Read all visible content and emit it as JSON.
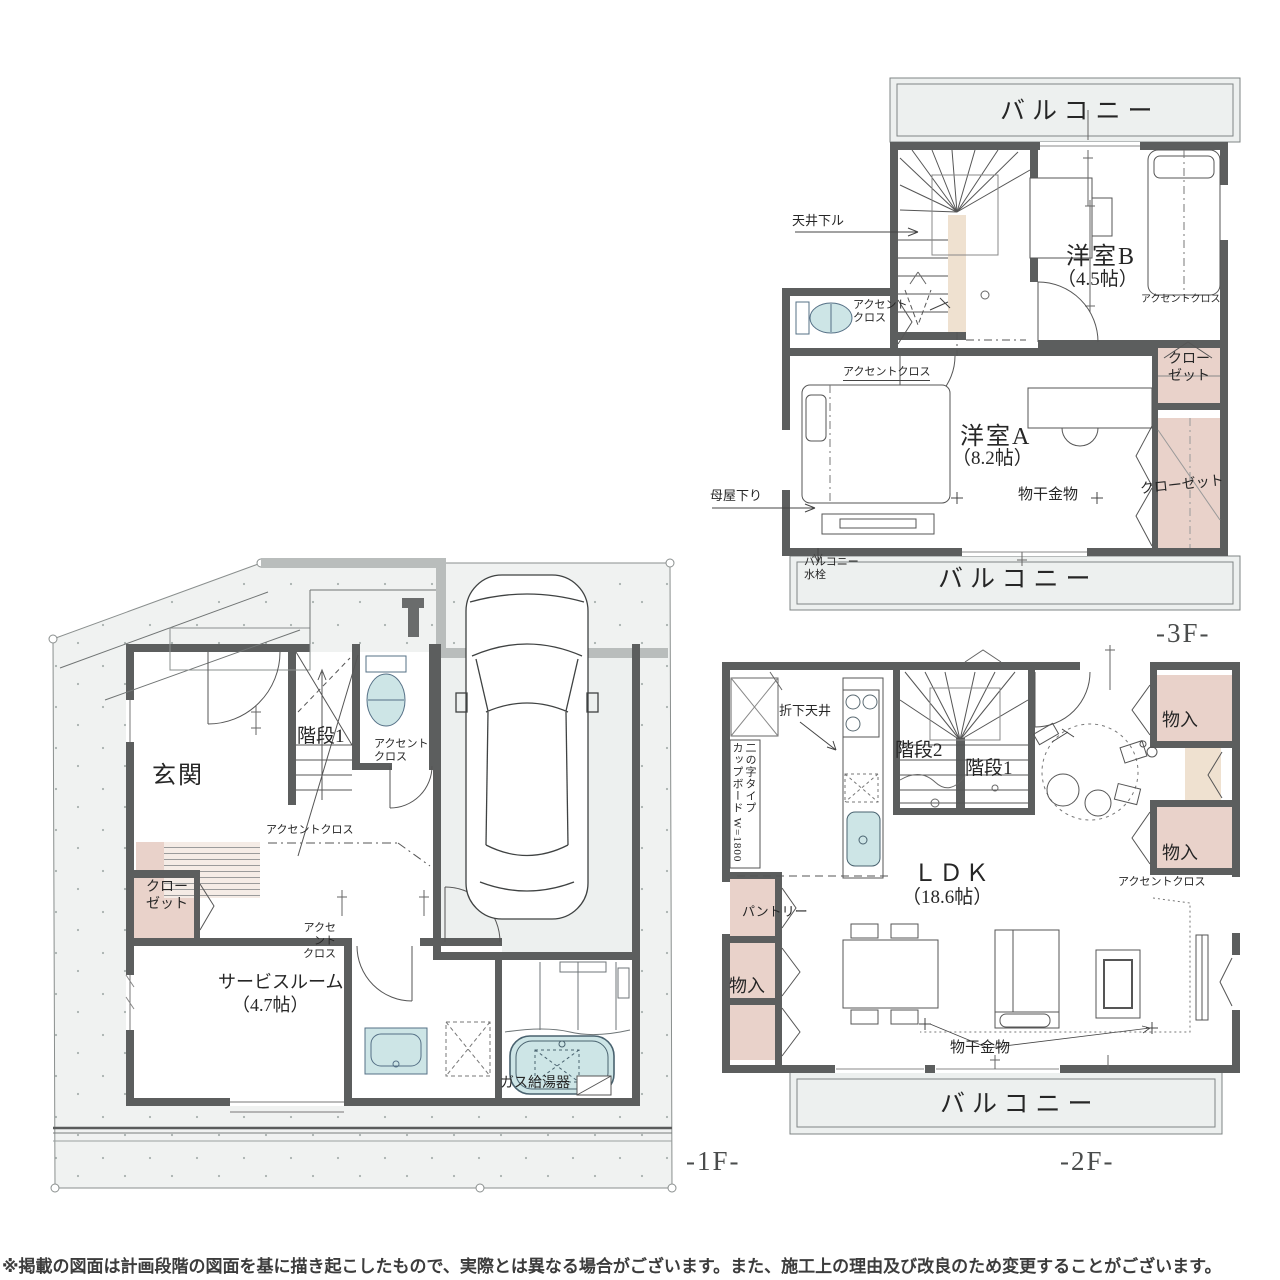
{
  "disclaimer": "※掲載の図面は計画段階の図面を基に描き起こしたもので、実際とは異なる場合がございます。また、施工上の理由及び改良のため変更することがございます。",
  "colors": {
    "wall": "#5c5e5e",
    "closet_pink": "#e9d2ca",
    "fixture_blue": "#cde5e6",
    "balcony_gray": "#edf0ef",
    "accent_beige": "#efe1d0"
  },
  "floor1": {
    "tag": "-1F-",
    "genkan": "玄関",
    "kaidan1": "階段1",
    "accent_cross_toilet": "アクセント\nクロス",
    "accent_cross_hall": "アクセントクロス",
    "closet": "クロー\nゼット",
    "accent_cross_service": "アクセント\nクロス",
    "service_room": "サービスルーム",
    "service_room_size": "（4.7帖）",
    "gas_heater": "ガス給湯器"
  },
  "floor2": {
    "tag": "-2F-",
    "orishita_tenjo": "折下天井",
    "cupboard_col1": "カップボード W=1800",
    "cupboard_col2": "二の字タイプ",
    "kaidan2": "階段2",
    "kaidan1": "階段1",
    "monoire_top_right": "物入",
    "monoire_mid_right": "物入",
    "ldk": "ＬＤＫ",
    "ldk_size": "（18.6帖）",
    "accent_cross": "アクセントクロス",
    "pantry": "パントリー",
    "monoire_left": "物入",
    "monohoshi": "物干金物",
    "balcony": "バルコニー"
  },
  "floor3": {
    "tag": "-3F-",
    "balcony_top": "バルコニー",
    "tenjo_sagari": "天井下ル",
    "accent_cross_toilet": "アクセント\nクロス",
    "yoshitsu_b": "洋室B",
    "yoshitsu_b_size": "（4.5帖）",
    "accent_cross_b": "アクセントクロス",
    "closet_top_right": "クロー\nゼット",
    "accent_cross_a": "アクセントクロス",
    "yoshitsu_a": "洋室A",
    "yoshitsu_a_size": "（8.2帖）",
    "monohoshi": "物干金物",
    "closet_right": "クローゼット",
    "moya_sagari": "母屋下り",
    "balcony_faucet": "バルコニー\n水栓",
    "balcony_bottom": "バルコニー"
  }
}
